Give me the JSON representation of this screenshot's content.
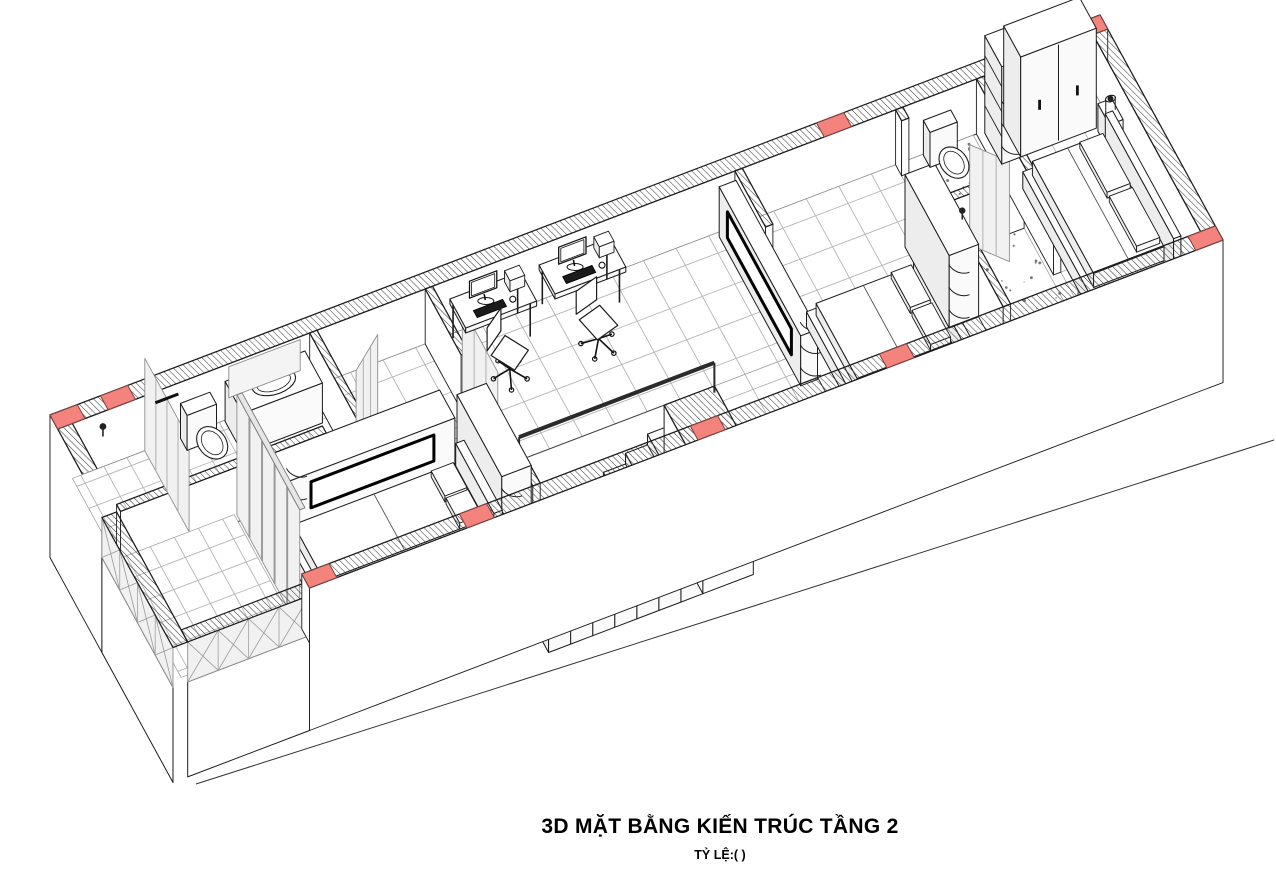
{
  "title_block": {
    "title": "3D MẶT BẰNG KIẾN TRÚC TẦNG 2",
    "scale_label": "TỶ LỆ:( )"
  },
  "colors": {
    "paper": "#ffffff",
    "line": "#1c1c1c",
    "hatch_line": "#3a3a3a",
    "column_red": "#f4827d",
    "column_red_stroke": "#7c423d",
    "tile_line": "#b5b5b5",
    "glass_fill": "#f1f1f1",
    "glass_line": "#a8a8a8",
    "face_side": "#ededed",
    "face_front": "#fafafa",
    "rail_dark": "#2b2b2b",
    "speckle": "#777777"
  },
  "projection": {
    "ox": 50,
    "oy": 470,
    "ux": 0.525,
    "uy": -0.2,
    "vx": 0.2733,
    "vy": 0.5,
    "zs": 0.5,
    "cut": 110
  },
  "scene": {
    "ground_line": [
      [
        196,
        784
      ],
      [
        1274,
        440
      ]
    ],
    "exterior_walls": [
      {
        "name": "back-wall",
        "rect": [
          0,
          0,
          2000,
          28
        ],
        "faces": {
          "y": 0,
          "x": -175
        }
      },
      {
        "name": "left-end-wall",
        "rect": [
          0,
          0,
          28,
          190
        ],
        "faces": {
          "x": -175,
          "y": 0
        }
      },
      {
        "name": "east-end-wall",
        "rect": [
          1972,
          0,
          2000,
          450
        ],
        "faces": {
          "x": 0,
          "y": -175
        }
      }
    ],
    "front_wall": {
      "name": "front-wall",
      "rect": [
        260,
        422,
        2000,
        450
      ],
      "faces": {
        "y": -175,
        "x": 0
      }
    },
    "back_columns": [
      [
        0,
        52
      ],
      [
        96,
        148
      ],
      [
        1460,
        1512
      ],
      [
        1948,
        2000
      ]
    ],
    "front_columns": [
      [
        260,
        312
      ],
      [
        560,
        612
      ],
      [
        1000,
        1052
      ],
      [
        1360,
        1412
      ],
      [
        1948,
        2000
      ]
    ],
    "back_window": {
      "name": "master-back-window",
      "x1": 1896,
      "x2": 1946
    },
    "interior_walls": [
      {
        "name": "bathroom1-front-wall",
        "rect": [
          28,
          190,
          420,
          204
        ]
      },
      {
        "name": "bathroom1-side-wall",
        "rect": [
          480,
          28,
          494,
          204
        ]
      },
      {
        "name": "cross-wall-1-back",
        "rect": [
          700,
          28,
          714,
          160
        ]
      },
      {
        "name": "cross-wall-1-front",
        "rect": [
          700,
          290,
          714,
          422
        ]
      },
      {
        "name": "cross-wall-2-back",
        "rect": [
          1290,
          28,
          1304,
          140
        ]
      },
      {
        "name": "cross-wall-2-front",
        "rect": [
          1290,
          330,
          1304,
          422
        ]
      },
      {
        "name": "cross-wall-3-back",
        "rect": [
          1596,
          28,
          1610,
          50
        ]
      },
      {
        "name": "cross-wall-3-mid",
        "rect": [
          1596,
          160,
          1610,
          422
        ]
      },
      {
        "name": "bathroom2-mid-wall",
        "rect": [
          1610,
          200,
          1744,
          214
        ]
      },
      {
        "name": "cross-wall-4-back",
        "rect": [
          1750,
          28,
          1764,
          310
        ]
      },
      {
        "name": "cross-wall-4-front",
        "rect": [
          1750,
          400,
          1764,
          422
        ]
      }
    ],
    "floors": [
      {
        "name": "bathroom1-floor",
        "rect": [
          28,
          28,
          480,
          190
        ],
        "tile": 44
      },
      {
        "name": "bedroom1-floor-back",
        "rect": [
          494,
          28,
          700,
          204
        ],
        "tile": 62
      },
      {
        "name": "bedroom1-floor",
        "rect": [
          266,
          204,
          700,
          422
        ],
        "tile": 62
      },
      {
        "name": "hall-floor-back",
        "rect": [
          714,
          28,
          1290,
          280
        ],
        "tile": 62
      },
      {
        "name": "hall-floor-side",
        "rect": [
          1120,
          280,
          1290,
          422
        ],
        "tile": 62
      },
      {
        "name": "bedroom2-floor",
        "rect": [
          1304,
          28,
          1596,
          422
        ],
        "tile": 62
      },
      {
        "name": "bathroom2-toilet-floor",
        "rect": [
          1610,
          28,
          1744,
          200
        ],
        "speckle": 26
      },
      {
        "name": "bathroom2-shower-floor",
        "rect": [
          1610,
          214,
          1744,
          422
        ],
        "speckle": 40
      },
      {
        "name": "master-floor",
        "rect": [
          1764,
          28,
          1972,
          422
        ],
        "tile": 62
      }
    ],
    "stairs": {
      "name": "staircase",
      "well": [
        720,
        280,
        1120,
        422
      ],
      "steps": {
        "x0": 730,
        "n": 7,
        "w": 42,
        "y1": 300,
        "y2": 422,
        "ztop0": -150,
        "dz": 21.5,
        "z0": -235
      },
      "stringer": [
        1024,
        280,
        1120,
        422
      ],
      "rail": {
        "x1": 742,
        "x2": 1114,
        "y": 291,
        "z": 60
      }
    },
    "doors": [
      {
        "name": "bathroom1-door",
        "hinge": [
          480,
          198
        ],
        "end": [
          545,
          152
        ],
        "h": 205,
        "glass": true
      },
      {
        "name": "bedroom1-sliding-door",
        "slide": [
          702,
          160,
          712,
          290
        ],
        "h": 205
      },
      {
        "name": "bathroom2-door",
        "hinge": [
          1603,
          164
        ],
        "end": [
          1560,
          226
        ],
        "h": 205,
        "glass": true
      },
      {
        "name": "shower-door",
        "hinge": [
          1644,
          207
        ],
        "end": [
          1692,
          260
        ],
        "h": 200,
        "glass": true
      },
      {
        "name": "master-bath-door",
        "hinge": [
          1757,
          402
        ],
        "end": [
          1812,
          358
        ],
        "h": 205,
        "glass": false
      }
    ],
    "bath1": {
      "toilet_tank": [
        233,
        30,
        289,
        54
      ],
      "toilet_bowl": {
        "c": [
          261,
          92
        ],
        "r": [
          25,
          31
        ]
      },
      "vanity": [
        318,
        30,
        470,
        94
      ],
      "basin": {
        "c": [
          394,
          62
        ],
        "r": [
          40,
          22
        ]
      },
      "faucet": [
        394,
        38
      ],
      "mirror": {
        "x1": 326,
        "x2": 462,
        "z1": 42,
        "z2": 104
      },
      "shower_glass": [
        166,
        28,
        174,
        190
      ],
      "shower_head": [
        80,
        40
      ],
      "towel_bar": [
        186,
        230
      ]
    },
    "bath2": {
      "toilet_tank": [
        1648,
        30,
        1700,
        54
      ],
      "toilet_bowl": {
        "c": [
          1672,
          96
        ],
        "r": [
          24,
          30
        ]
      },
      "shower_head": [
        1622,
        222
      ]
    },
    "consoles": [
      {
        "name": "tv-console-bedroom1",
        "rect": [
          320,
          196,
          640,
          252
        ],
        "h": 100,
        "niche": {
          "side": "y",
          "a1": 366,
          "a2": 600,
          "z1": 30,
          "z2": 82
        },
        "arc": [
          320,
          252
        ]
      },
      {
        "name": "tv-console-hall",
        "rect": [
          1256,
          36,
          1288,
          334
        ],
        "h": 100,
        "niche": {
          "side": "x",
          "a1": 66,
          "a2": 300,
          "z1": 28,
          "z2": 80
        },
        "arc": [
          1256,
          334
        ]
      }
    ],
    "wardrobes": [
      {
        "name": "wardrobe-bedroom1",
        "rect": [
          642,
          256,
          698,
          420
        ],
        "h": 150,
        "arc": [
          642,
          420
        ]
      },
      {
        "name": "wardrobe-bedroom2",
        "rect": [
          1540,
          170,
          1596,
          332
        ],
        "h": 145,
        "arc": [
          1540,
          332
        ]
      },
      {
        "name": "curved-shelf-master",
        "rect": [
          1764,
          32,
          1800,
          94
        ],
        "h": 195,
        "arc": [
          1764,
          94
        ],
        "open": true
      },
      {
        "name": "wardrobe-master",
        "rect": [
          1800,
          32,
          1944,
          94
        ],
        "h": 200,
        "doors": 2
      }
    ],
    "desks": [
      {
        "name": "desk-1",
        "rect": [
          745,
          32,
          880,
          90
        ],
        "mon": 800,
        "chair": {
          "c": [
            806,
            134
          ],
          "rot": -32
        }
      },
      {
        "name": "desk-2",
        "rect": [
          915,
          32,
          1050,
          90
        ],
        "mon": 970,
        "chair": {
          "c": [
            972,
            140
          ],
          "rot": -14
        }
      }
    ],
    "beds": [
      {
        "name": "bed-bedroom1",
        "platform": [
          300,
          282,
          642,
          414
        ],
        "ph": 32,
        "mattress": [
          312,
          292,
          618,
          404
        ],
        "mh": 26,
        "pillows": [
          [
            570,
            300,
            612,
            350
          ],
          [
            570,
            354,
            612,
            404
          ]
        ],
        "headboard": [
          628,
          278,
          644,
          418
        ],
        "hh": 80
      },
      {
        "name": "bed-bedroom2",
        "platform": [
          1316,
          240,
          1522,
          412
        ],
        "ph": 30,
        "mattress": [
          1328,
          252,
          1508,
          402
        ],
        "mh": 24,
        "pillows": [
          [
            1468,
            258,
            1506,
            328
          ],
          [
            1468,
            334,
            1506,
            402
          ]
        ],
        "headboard": [
          1522,
          236,
          1538,
          416
        ],
        "hh": 64
      },
      {
        "name": "bed-master",
        "platform": [
          1776,
          148,
          1948,
          394
        ],
        "ph": 34,
        "mattress": [
          1788,
          160,
          1922,
          384
        ],
        "mh": 28,
        "pillows": [
          [
            1874,
            168,
            1918,
            268
          ],
          [
            1874,
            276,
            1918,
            376
          ]
        ],
        "headboard": [
          1934,
          146,
          1948,
          396
        ],
        "hh": 85
      }
    ],
    "bedside": {
      "name": "nightstand-master",
      "rect": [
        1944,
        100,
        1970,
        142
      ],
      "h": 55,
      "lamp": {
        "c": [
          1957,
          121
        ],
        "r": 9,
        "h": 26
      }
    },
    "bench": {
      "name": "bench-master",
      "rect": [
        1892,
        398,
        1946,
        420
      ],
      "h": 40
    },
    "curtain": {
      "name": "balcony-glass-wall",
      "x1": 256,
      "x2": 266,
      "y1": 192,
      "y2": 422,
      "h": 240,
      "mullions": 5
    },
    "balcony_floor": {
      "name": "balcony-floor",
      "rect": [
        28,
        190,
        252,
        426
      ],
      "tile": 46
    },
    "parapets": [
      {
        "name": "balcony-parapet-front",
        "rect": [
          28,
          426,
          260,
          450
        ],
        "face": "y"
      },
      {
        "name": "balcony-parapet-side",
        "rect": [
          0,
          190,
          28,
          450
        ],
        "face": "x"
      }
    ]
  }
}
